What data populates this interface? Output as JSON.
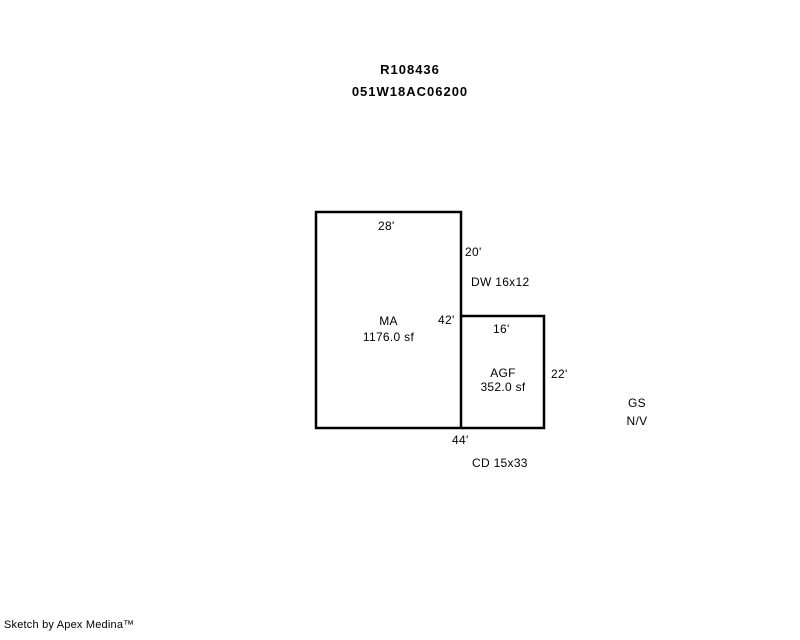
{
  "page": {
    "background": "#ffffff",
    "line_color": "#000000"
  },
  "header": {
    "record_id": "R108436",
    "parcel_id": "051W18AC06200"
  },
  "sketch": {
    "ma": {
      "code": "MA",
      "area": "1176.0 sf",
      "top_dim": "28'",
      "side_dim": "42'"
    },
    "agf": {
      "code": "AGF",
      "area": "352.0 sf",
      "top_dim": "16'",
      "side_dim": "22'"
    },
    "right_upper_dim": "20'",
    "bottom_dim": "44'",
    "dw_note": "DW 16x12",
    "cd_note": "CD 15x33",
    "gs_note": {
      "line1": "GS",
      "line2": "N/V"
    }
  },
  "footer": {
    "credit": "Sketch by Apex Medina™"
  }
}
